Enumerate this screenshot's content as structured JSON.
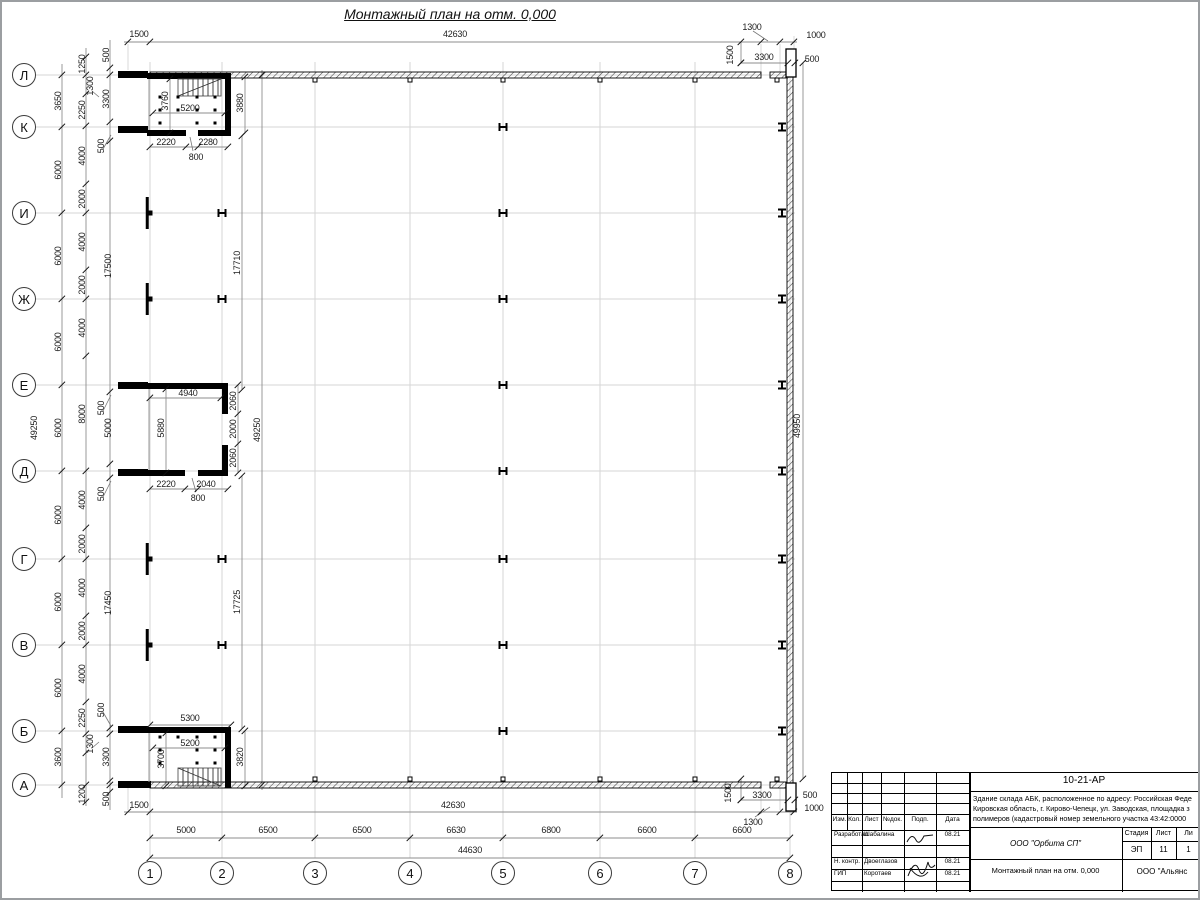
{
  "page": {
    "title": "Монтажный план на отм. 0,000"
  },
  "axes": {
    "rows": [
      {
        "label": "Л",
        "y": 75
      },
      {
        "label": "К",
        "y": 127
      },
      {
        "label": "И",
        "y": 213
      },
      {
        "label": "Ж",
        "y": 299
      },
      {
        "label": "Е",
        "y": 385
      },
      {
        "label": "Д",
        "y": 471
      },
      {
        "label": "Г",
        "y": 559
      },
      {
        "label": "В",
        "y": 645
      },
      {
        "label": "Б",
        "y": 731
      },
      {
        "label": "А",
        "y": 785
      }
    ],
    "cols": [
      {
        "label": "1",
        "x": 150
      },
      {
        "label": "2",
        "x": 222
      },
      {
        "label": "3",
        "x": 315
      },
      {
        "label": "4",
        "x": 410
      },
      {
        "label": "5",
        "x": 503
      },
      {
        "label": "6",
        "x": 600
      },
      {
        "label": "7",
        "x": 695
      },
      {
        "label": "8",
        "x": 790
      }
    ]
  },
  "annotations": [
    {
      "t": "1500",
      "x": 139,
      "y": 34
    },
    {
      "t": "42630",
      "x": 455,
      "y": 34
    },
    {
      "t": "1300",
      "x": 752,
      "y": 27
    },
    {
      "t": "1000",
      "x": 816,
      "y": 35
    },
    {
      "t": "1500",
      "x": 730,
      "y": 55,
      "r": 1
    },
    {
      "t": "3300",
      "x": 764,
      "y": 57
    },
    {
      "t": "500",
      "x": 812,
      "y": 59
    },
    {
      "t": "500",
      "x": 106,
      "y": 55,
      "r": 1
    },
    {
      "t": "1250",
      "x": 82,
      "y": 64,
      "r": 1
    },
    {
      "t": "1300",
      "x": 90,
      "y": 86,
      "r": 1
    },
    {
      "t": "3650",
      "x": 58,
      "y": 101,
      "r": 1
    },
    {
      "t": "2250",
      "x": 82,
      "y": 110,
      "r": 1
    },
    {
      "t": "3300",
      "x": 106,
      "y": 99,
      "r": 1
    },
    {
      "t": "500",
      "x": 101,
      "y": 146,
      "r": 1
    },
    {
      "t": "6000",
      "x": 58,
      "y": 170,
      "r": 1
    },
    {
      "t": "4000",
      "x": 82,
      "y": 156,
      "r": 1
    },
    {
      "t": "2000",
      "x": 82,
      "y": 199,
      "r": 1
    },
    {
      "t": "17500",
      "x": 108,
      "y": 266,
      "r": 1
    },
    {
      "t": "17710",
      "x": 237,
      "y": 263,
      "r": 1
    },
    {
      "t": "6000",
      "x": 58,
      "y": 256,
      "r": 1
    },
    {
      "t": "4000",
      "x": 82,
      "y": 242,
      "r": 1
    },
    {
      "t": "2000",
      "x": 82,
      "y": 285,
      "r": 1
    },
    {
      "t": "6000",
      "x": 58,
      "y": 342,
      "r": 1
    },
    {
      "t": "4000",
      "x": 82,
      "y": 328,
      "r": 1
    },
    {
      "t": "500",
      "x": 101,
      "y": 408,
      "r": 1
    },
    {
      "t": "6000",
      "x": 58,
      "y": 428,
      "r": 1
    },
    {
      "t": "8000",
      "x": 82,
      "y": 414,
      "r": 1
    },
    {
      "t": "5000",
      "x": 108,
      "y": 428,
      "r": 1
    },
    {
      "t": "49250",
      "x": 34,
      "y": 428,
      "r": 1
    },
    {
      "t": "49250",
      "x": 257,
      "y": 430,
      "r": 1
    },
    {
      "t": "500",
      "x": 101,
      "y": 494,
      "r": 1
    },
    {
      "t": "6000",
      "x": 58,
      "y": 515,
      "r": 1
    },
    {
      "t": "4000",
      "x": 82,
      "y": 500,
      "r": 1
    },
    {
      "t": "2000",
      "x": 82,
      "y": 544,
      "r": 1
    },
    {
      "t": "17450",
      "x": 108,
      "y": 603,
      "r": 1
    },
    {
      "t": "17725",
      "x": 237,
      "y": 602,
      "r": 1
    },
    {
      "t": "6000",
      "x": 58,
      "y": 602,
      "r": 1
    },
    {
      "t": "4000",
      "x": 82,
      "y": 588,
      "r": 1
    },
    {
      "t": "2000",
      "x": 82,
      "y": 631,
      "r": 1
    },
    {
      "t": "6000",
      "x": 58,
      "y": 688,
      "r": 1
    },
    {
      "t": "4000",
      "x": 82,
      "y": 674,
      "r": 1
    },
    {
      "t": "500",
      "x": 101,
      "y": 710,
      "r": 1
    },
    {
      "t": "2250",
      "x": 82,
      "y": 718,
      "r": 1
    },
    {
      "t": "3600",
      "x": 58,
      "y": 757,
      "r": 1
    },
    {
      "t": "1300",
      "x": 90,
      "y": 744,
      "r": 1
    },
    {
      "t": "3300",
      "x": 106,
      "y": 757,
      "r": 1
    },
    {
      "t": "1200",
      "x": 82,
      "y": 794,
      "r": 1
    },
    {
      "t": "500",
      "x": 106,
      "y": 799,
      "r": 1
    },
    {
      "t": "49950",
      "x": 797,
      "y": 426,
      "r": 1
    },
    {
      "t": "1500",
      "x": 728,
      "y": 793,
      "r": 1
    },
    {
      "t": "3300",
      "x": 762,
      "y": 795
    },
    {
      "t": "500",
      "x": 810,
      "y": 795
    },
    {
      "t": "1000",
      "x": 814,
      "y": 808
    },
    {
      "t": "1300",
      "x": 753,
      "y": 822
    },
    {
      "t": "1500",
      "x": 139,
      "y": 805
    },
    {
      "t": "42630",
      "x": 453,
      "y": 805
    },
    {
      "t": "5000",
      "x": 186,
      "y": 830
    },
    {
      "t": "6500",
      "x": 268,
      "y": 830
    },
    {
      "t": "6500",
      "x": 362,
      "y": 830
    },
    {
      "t": "6630",
      "x": 456,
      "y": 830
    },
    {
      "t": "6800",
      "x": 551,
      "y": 830
    },
    {
      "t": "6600",
      "x": 647,
      "y": 830
    },
    {
      "t": "6600",
      "x": 742,
      "y": 830
    },
    {
      "t": "44630",
      "x": 470,
      "y": 850
    },
    {
      "t": "3760",
      "x": 165,
      "y": 101,
      "r": 1
    },
    {
      "t": "5200",
      "x": 190,
      "y": 108
    },
    {
      "t": "3880",
      "x": 240,
      "y": 103,
      "r": 1
    },
    {
      "t": "2220",
      "x": 166,
      "y": 142
    },
    {
      "t": "2280",
      "x": 208,
      "y": 142
    },
    {
      "t": "800",
      "x": 196,
      "y": 157
    },
    {
      "t": "4940",
      "x": 188,
      "y": 393
    },
    {
      "t": "5880",
      "x": 161,
      "y": 428,
      "r": 1
    },
    {
      "t": "2060",
      "x": 233,
      "y": 401,
      "r": 1
    },
    {
      "t": "2000",
      "x": 233,
      "y": 429,
      "r": 1
    },
    {
      "t": "2060",
      "x": 233,
      "y": 458,
      "r": 1
    },
    {
      "t": "2220",
      "x": 166,
      "y": 484
    },
    {
      "t": "2040",
      "x": 206,
      "y": 484
    },
    {
      "t": "800",
      "x": 198,
      "y": 498
    },
    {
      "t": "5300",
      "x": 190,
      "y": 718
    },
    {
      "t": "5200",
      "x": 190,
      "y": 743
    },
    {
      "t": "3700",
      "x": 161,
      "y": 759,
      "r": 1
    },
    {
      "t": "3820",
      "x": 240,
      "y": 757,
      "r": 1
    }
  ],
  "titleblock": {
    "doc_number": "10-21-АР",
    "description_lines": [
      "Здание склада АБК, расположенное по адресу: Российская Феде",
      "Кировская область, г. Кирово-Чепецк, ул. Заводская, площадка з",
      "полимеров (кадастровый номер земельного участка 43:42:0000"
    ],
    "columns": [
      "Изм.",
      "Кол.",
      "Лист",
      "№док.",
      "Подп.",
      "Дата"
    ],
    "staff": [
      {
        "role": "Разработал",
        "name": "Шабалина",
        "date": "08.21"
      },
      {
        "role": "Н. контр.",
        "name": "Двоеглазов",
        "date": "08.21"
      },
      {
        "role": "ГИП",
        "name": "Коротаев",
        "date": "08.21"
      }
    ],
    "org": "ООО \"Орбита СП\"",
    "stage_header": {
      "stage": "Стадия",
      "sheet": "Лист",
      "sheets": "Ли"
    },
    "stage_values": {
      "stage": "ЭП",
      "sheet": "11",
      "sheets": "1"
    },
    "sheet_title": "Монтажный план на отм. 0,000",
    "firm": "ООО \"Альянс"
  }
}
